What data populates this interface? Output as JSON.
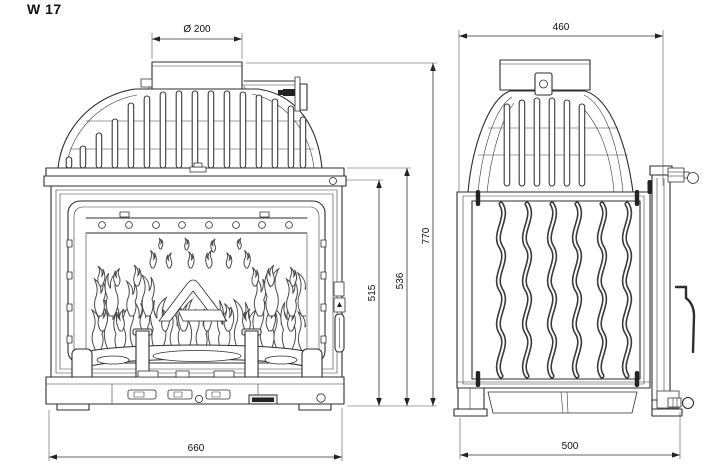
{
  "title": "W 17",
  "colors": {
    "background": "#ffffff",
    "line": "#2e2e2e",
    "dimension_text": "#111111"
  },
  "dimensions": {
    "flue_diameter": "Ø 200",
    "top_width": "460",
    "overall_height": "770",
    "body_height": "536",
    "door_height": "515",
    "overall_width": "660",
    "overall_depth": "500"
  }
}
